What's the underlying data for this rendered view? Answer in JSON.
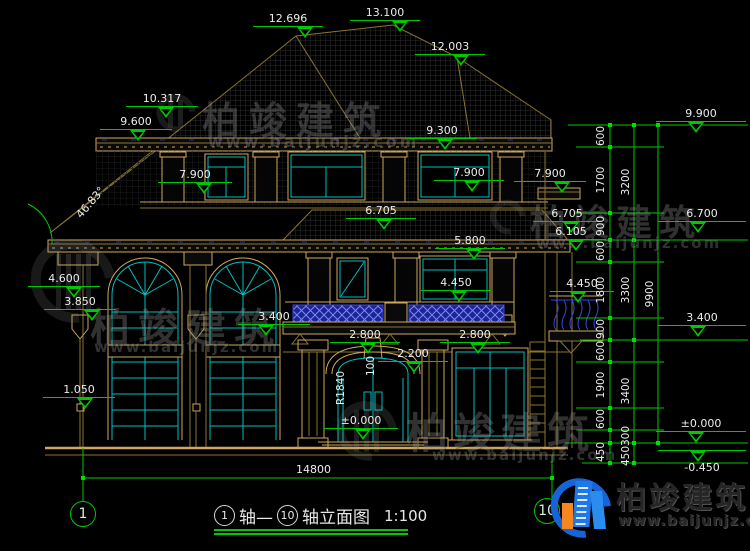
{
  "watermark": {
    "brand": "柏竣建筑",
    "url": "www.baijunjz.com"
  },
  "logo": {
    "brand": "柏竣建筑",
    "url": "www.baijunjz.com"
  },
  "annotations": {
    "roof_angle": "46.83°",
    "door_radius": "R1840",
    "door_offset": "100",
    "total_width": "14800"
  },
  "title": {
    "axis_start": "1",
    "join": "轴—",
    "axis_end": "10",
    "suffix": "轴立面图",
    "scale": "1:100"
  },
  "axis_bubbles": {
    "left": "1",
    "right": "10"
  },
  "elevation_markers": [
    {
      "label": "12.696",
      "x": 253,
      "y": 12,
      "w": 70,
      "t": 44
    },
    {
      "label": "13.100",
      "x": 350,
      "y": 6,
      "w": 70,
      "t": 42
    },
    {
      "label": "12.003",
      "x": 415,
      "y": 40,
      "w": 70,
      "t": 38
    },
    {
      "label": "10.317",
      "x": 126,
      "y": 92,
      "w": 72,
      "t": 32
    },
    {
      "label": "9.600",
      "x": 100,
      "y": 115,
      "w": 72,
      "t": 30
    },
    {
      "label": "7.900",
      "x": 158,
      "y": 168,
      "w": 74,
      "t": 38
    },
    {
      "label": "9.300",
      "x": 407,
      "y": 124,
      "w": 70,
      "t": 30
    },
    {
      "label": "7.900",
      "x": 434,
      "y": 166,
      "w": 70,
      "t": 30
    },
    {
      "label": "7.900",
      "x": 514,
      "y": 167,
      "w": 72,
      "t": 40
    },
    {
      "label": "6.705",
      "x": 346,
      "y": 204,
      "w": 70,
      "t": 30
    },
    {
      "label": "5.800",
      "x": 435,
      "y": 234,
      "w": 70,
      "t": 31
    },
    {
      "label": "4.450",
      "x": 421,
      "y": 276,
      "w": 70,
      "t": 30
    },
    {
      "label": "4.600",
      "x": 28,
      "y": 272,
      "w": 72,
      "t": 38
    },
    {
      "label": "3.850",
      "x": 44,
      "y": 295,
      "w": 72,
      "t": 40
    },
    {
      "label": "3.400",
      "x": 238,
      "y": 310,
      "w": 72,
      "t": 20
    },
    {
      "label": "2.800",
      "x": 330,
      "y": 328,
      "w": 70,
      "t": 30
    },
    {
      "label": "2.800",
      "x": 440,
      "y": 328,
      "w": 70,
      "t": 30
    },
    {
      "label": "2.200",
      "x": 378,
      "y": 347,
      "w": 70,
      "t": 28
    },
    {
      "label": "1.050",
      "x": 43,
      "y": 383,
      "w": 72,
      "t": 34
    },
    {
      "label": "±0.000",
      "x": 324,
      "y": 414,
      "w": 74,
      "t": 31
    },
    {
      "label": "9.900",
      "x": 656,
      "y": 107,
      "w": 90,
      "t": 32
    },
    {
      "label": "6.705",
      "x": 533,
      "y": 207,
      "w": 68,
      "t": 30
    },
    {
      "label": "6.105",
      "x": 536,
      "y": 225,
      "w": 70,
      "t": 32
    },
    {
      "label": "6.700",
      "x": 658,
      "y": 207,
      "w": 88,
      "t": 32
    },
    {
      "label": "4.450",
      "x": 550,
      "y": 277,
      "w": 64,
      "t": 20
    },
    {
      "label": "3.400",
      "x": 658,
      "y": 311,
      "w": 88,
      "t": 32
    },
    {
      "label": "±0.000",
      "x": 656,
      "y": 417,
      "w": 90,
      "t": 32
    },
    {
      "label": "-0.450",
      "x": 658,
      "y": 449,
      "w": 88,
      "t": 32,
      "flip": true
    }
  ],
  "dim_chain": {
    "columns": [
      {
        "x": 601,
        "labels": [
          {
            "v": "600",
            "y": 136
          },
          {
            "v": "1700",
            "y": 180
          },
          {
            "v": "900",
            "y": 226
          },
          {
            "v": "600",
            "y": 251
          },
          {
            "v": "1800",
            "y": 290
          },
          {
            "v": "900",
            "y": 329
          },
          {
            "v": "600",
            "y": 351
          },
          {
            "v": "1900",
            "y": 385
          },
          {
            "v": "600",
            "y": 419
          },
          {
            "v": "450",
            "y": 452
          }
        ]
      },
      {
        "x": 626,
        "labels": [
          {
            "v": "3200",
            "y": 182
          },
          {
            "v": "3300",
            "y": 290
          },
          {
            "v": "3400",
            "y": 391
          },
          {
            "v": "300",
            "y": 436
          },
          {
            "v": "450",
            "y": 456
          }
        ]
      },
      {
        "x": 650,
        "labels": [
          {
            "v": "9900",
            "y": 294
          }
        ]
      }
    ]
  },
  "colors": {
    "background": "#000000",
    "line_tan": "#cda85c",
    "line_dim": "#8a7433",
    "frame_cyan": "#00bfbf",
    "dim_green": "#00c800",
    "railing_blue": "#3643df",
    "text_white": "#ececec",
    "logo_blue": "#1565d8",
    "logo_orange": "#f5871e"
  }
}
